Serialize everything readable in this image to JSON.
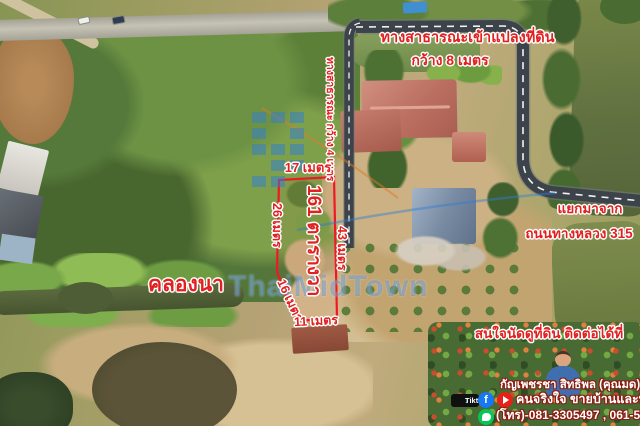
{
  "annotations": {
    "top_road": {
      "line1": "ทางสาธารณะเข้าแปลงที่ดิน",
      "line2": "กว้าง 8 เมตร"
    },
    "access_road_label": "ทางสาธารณะ กว้าง 4 เมตร",
    "junction": {
      "line1": "แยกมาจาก",
      "line2": "ถนนทางหลวง 315"
    },
    "canal_label": "คลองนา",
    "plot": {
      "area": "161 ตารางวา",
      "side_top": "17 เมตร",
      "side_left": "26 เมตร",
      "side_right": "43 เมตร",
      "side_slant": "16 เมตร",
      "side_bottom": "11 เมตร"
    },
    "cta": "สนใจนัดดูที่ดิน ติดต่อได้ที่"
  },
  "contact": {
    "name": "กัญเพชรชา สิทธิพล (คุณมด)",
    "tagline": "คนจริงใจ ขายบ้านและที่ดิน",
    "phone": "(โทร)-081-3305497 , 061-5765520",
    "tiktok_label": "Tiktok",
    "icons": {
      "facebook_glyph": "f",
      "tiktok_note": "♪"
    }
  },
  "watermark": {
    "brand": "ThaiMidTown"
  },
  "colors": {
    "annotation_red": "#e2201f",
    "road_gray": "#3d434a",
    "watermark_blue": "#2e7fd6",
    "contact_text": "#ffffff",
    "outline_white": "#ffffff"
  }
}
